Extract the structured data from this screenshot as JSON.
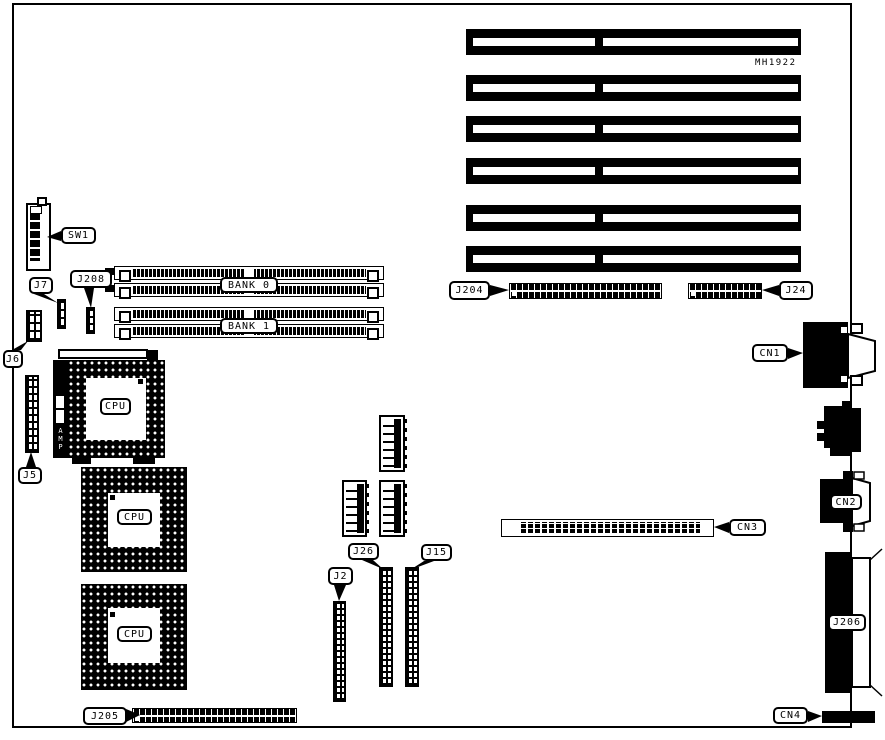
{
  "board": {
    "part_number": "MH1922",
    "cpu_label": "CPU",
    "amp_label": "AMP",
    "banks": {
      "bank0": "BANK 0",
      "bank1": "BANK 1"
    },
    "labels": {
      "sw1": "SW1",
      "j7": "J7",
      "j208": "J208",
      "j6": "J6",
      "j5": "J5",
      "j204": "J204",
      "j24": "J24",
      "cn1": "CN1",
      "cn2": "CN2",
      "cn3": "CN3",
      "cn4": "CN4",
      "j206": "J206",
      "j26": "J26",
      "j15": "J15",
      "j2": "J2",
      "j205": "J205"
    }
  }
}
